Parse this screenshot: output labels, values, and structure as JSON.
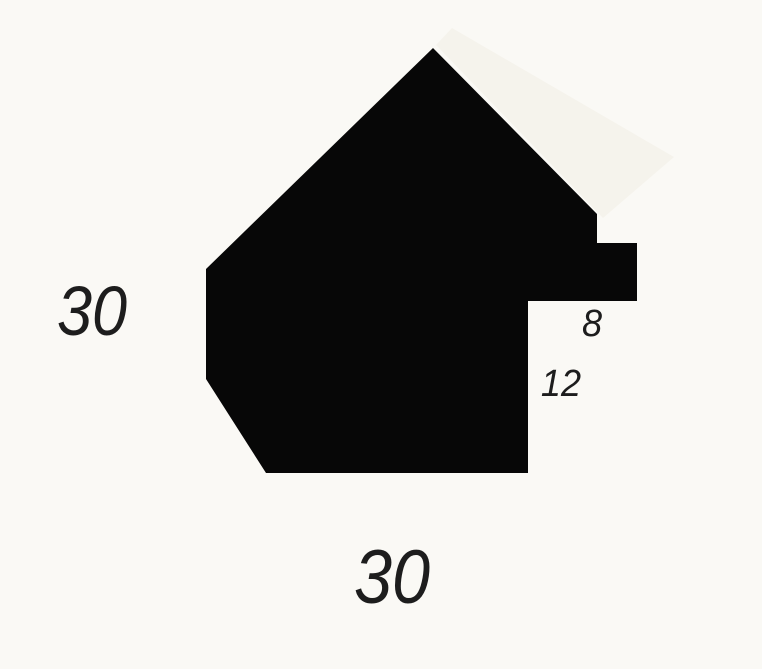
{
  "page": {
    "background_color": "#faf9f5",
    "description": "Cross-section profile drawing of a picture frame moulding with dimensions"
  },
  "profile": {
    "silhouette_fill": "#070707",
    "outline_points": "433,48 597,214 597,243 637,243 637,301 528,301 528,473 266,473 206,379 206,269",
    "highlight_band_points": "436,45 452,28 674,157 603,218",
    "highlight_band_fill": "#f5f3ec"
  },
  "dimensions": {
    "overall_height": "30",
    "overall_width": "30",
    "rabbet_width": "8",
    "rabbet_depth": "12"
  }
}
